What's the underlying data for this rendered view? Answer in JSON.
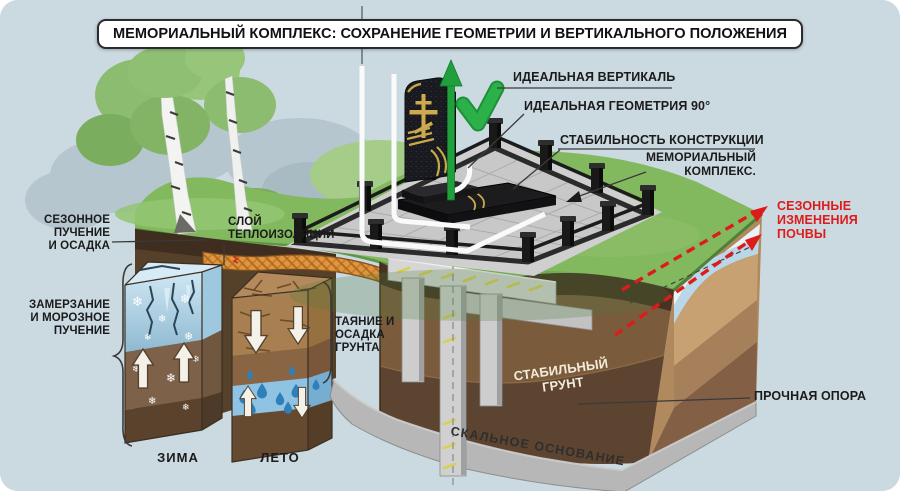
{
  "title": "МЕМОРИАЛЬНЫЙ КОМПЛЕКС: СОХРАНЕНИЕ ГЕОМЕТРИИ И ВЕРТИКАЛЬНОГО ПОЛОЖЕНИЯ",
  "callouts": {
    "ideal_vertical": "ИДЕАЛЬНАЯ ВЕРТИКАЛЬ",
    "ideal_geometry": "ИДЕАЛЬНАЯ ГЕОМЕТРИЯ 90°",
    "stability": "СТАБИЛЬНОСТЬ КОНСТРУКЦИИ",
    "memorial_complex": "МЕМОРИАЛЬНЫЙ\nКОМПЛЕКС.",
    "seasonal_changes": "СЕЗОННЫЕ\nИЗМЕНЕНИЯ\nПОЧВЫ",
    "seasonal_heave": "СЕЗОННОЕ\nПУЧЕНИЕ\nИ ОСАДКА",
    "insulation_layer": "СЛОЙ\nТЕПЛОИЗОЛЯЦИИ",
    "freeze_heave": "ЗАМЕРЗАНИЕ\nИ МОРОЗНОЕ\nПУЧЕНИЕ",
    "thaw_settlement": "ТАЯНИЕ И\nОСАДКА\nГРУНТА",
    "stable_ground": "СТАБИЛЬНЫЙ\nГРУНТ",
    "firm_support": "ПРОЧНАЯ ОПОРА",
    "bedrock": "СКАЛЬНОЕ ОСНОВАНИЕ",
    "winter": "ЗИМА",
    "summer": "ЛЕТО"
  },
  "colors": {
    "sky": "#cbd9e1",
    "grass": "#82b85e",
    "soil_dark": "#55402a",
    "soil_mid": "#7d5c3c",
    "soil_tan": "#c8a173",
    "rock": "#b7b7b7",
    "insulation": "#e2953e",
    "ice": "#b7d9e9",
    "water": "#2f7fb8",
    "alert_red": "#de1b1b",
    "ok_green": "#2cb14a",
    "label": "#1b1b1b"
  }
}
